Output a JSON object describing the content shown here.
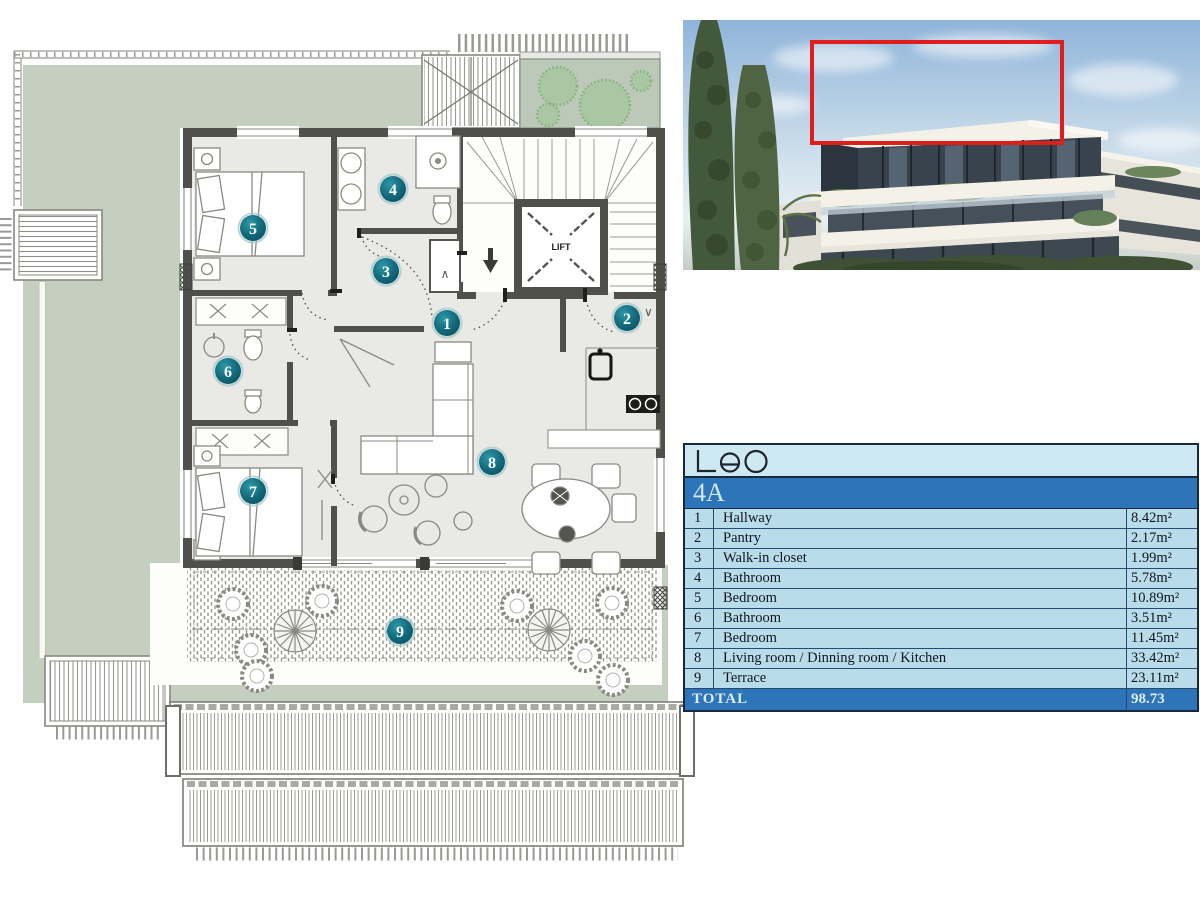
{
  "logo": {
    "text": "Leo"
  },
  "unit": {
    "label": "4A"
  },
  "rooms": [
    {
      "num": "1",
      "name": "Hallway",
      "area": "8.42m²"
    },
    {
      "num": "2",
      "name": "Pantry",
      "area": "2.17m²"
    },
    {
      "num": "3",
      "name": "Walk-in closet",
      "area": "1.99m²"
    },
    {
      "num": "4",
      "name": "Bathroom",
      "area": "5.78m²"
    },
    {
      "num": "5",
      "name": "Bedroom",
      "area": "10.89m²"
    },
    {
      "num": "6",
      "name": "Bathroom",
      "area": "3.51m²"
    },
    {
      "num": "7",
      "name": "Bedroom",
      "area": "11.45m²"
    },
    {
      "num": "8",
      "name": "Living room / Dinning room / Kitchen",
      "area": "33.42m²"
    },
    {
      "num": "9",
      "name": "Terrace",
      "area": "23.11m²"
    }
  ],
  "total": {
    "label": "TOTAL",
    "value": "98.73"
  },
  "plan": {
    "lift_label": "LIFT",
    "closet_glyph": "∧",
    "pantry_glyph": "∨",
    "markers": [
      {
        "n": "1",
        "x": 447,
        "y": 323
      },
      {
        "n": "2",
        "x": 627,
        "y": 318
      },
      {
        "n": "3",
        "x": 386,
        "y": 271
      },
      {
        "n": "4",
        "x": 393,
        "y": 189
      },
      {
        "n": "5",
        "x": 253,
        "y": 228
      },
      {
        "n": "6",
        "x": 228,
        "y": 371
      },
      {
        "n": "7",
        "x": 253,
        "y": 491
      },
      {
        "n": "8",
        "x": 492,
        "y": 462
      },
      {
        "n": "9",
        "x": 400,
        "y": 631
      }
    ]
  },
  "colors": {
    "table_blue": "#2e74b8",
    "table_light": "#b9dcea",
    "marker_teal": "#136b7c",
    "garden_green": "#c4cfc0",
    "highlight_red": "#e01d1d",
    "wall_grey": "#4f4f4b"
  }
}
